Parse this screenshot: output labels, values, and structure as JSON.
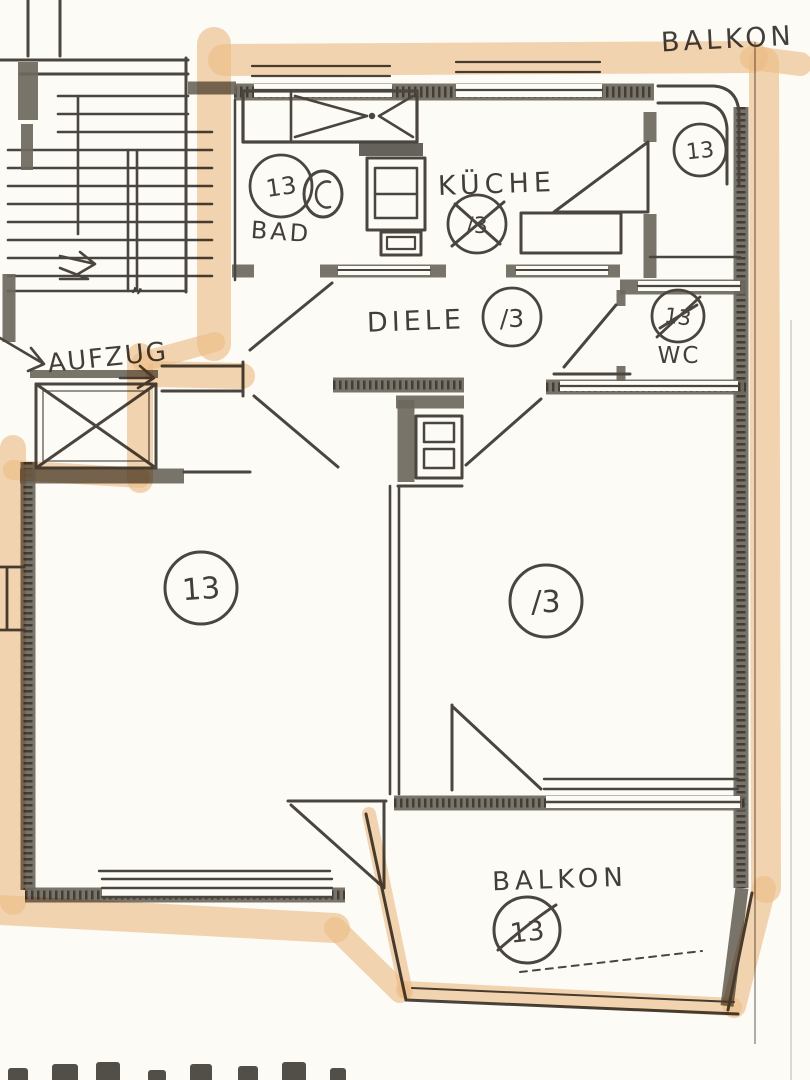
{
  "plan": {
    "colors": {
      "highlight": "#efbe8a",
      "ink": "#4a463f",
      "paper": "#fcfbf6"
    },
    "labels": {
      "balkon_top": {
        "label": "BALKON",
        "number": "13",
        "crossed": false
      },
      "bad": {
        "label": "BAD",
        "number": "13",
        "crossed": false
      },
      "kueche": {
        "label": "KÜCHE",
        "number": "/3",
        "crossed": true
      },
      "diele": {
        "label": "DIELE",
        "number": "/3",
        "crossed": false
      },
      "wc": {
        "label": "WC",
        "number": "13",
        "crossed": true
      },
      "aufzug": {
        "label": "AUFZUG"
      },
      "room_left": {
        "number": "13"
      },
      "room_right": {
        "number": "/3"
      },
      "balkon_bottom": {
        "label": "BALKON",
        "number": "13",
        "crossed": true
      },
      "stair_mark": {
        "mark": "”"
      }
    }
  }
}
